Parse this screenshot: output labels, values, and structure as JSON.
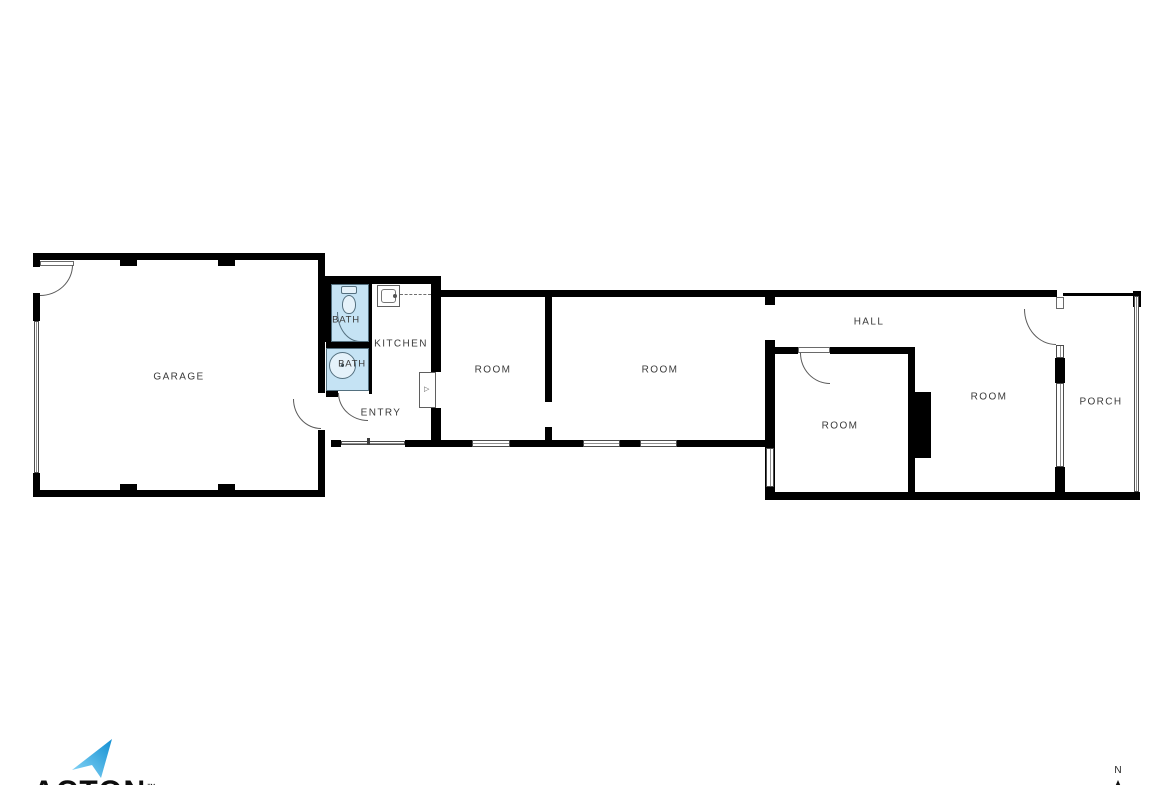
{
  "plan_title": "Single-story floor plan",
  "rooms": {
    "garage": {
      "label": "GARAGE"
    },
    "bath1": {
      "label": "BATH"
    },
    "bath2": {
      "label": "BATH"
    },
    "kitchen": {
      "label": "KITCHEN"
    },
    "entry": {
      "label": "ENTRY"
    },
    "room1": {
      "label": "ROOM"
    },
    "room2": {
      "label": "ROOM"
    },
    "hall": {
      "label": "HALL"
    },
    "room3": {
      "label": "ROOM"
    },
    "room4": {
      "label": "ROOM"
    },
    "porch": {
      "label": "PORCH"
    }
  },
  "compass": {
    "label": "N"
  },
  "logo": {
    "text": "ACTON",
    "trademark": "™"
  },
  "icons": {
    "logo_arrow": "blue-upward-arrow",
    "north_arrow": "triangle-up",
    "toilet": "toilet-top-view",
    "shower": "round-shower-basin",
    "sink": "kitchen-sink",
    "water_heater": "water-heater-unit"
  },
  "colors": {
    "wall": "#000000",
    "bath_fill": "#c5e3f4",
    "fixture_outline": "#54707f",
    "label_text": "#3a3a3a",
    "logo_blue_light": "#8ed9f8",
    "logo_blue_dark": "#128fd2",
    "window_line": "#909090"
  }
}
